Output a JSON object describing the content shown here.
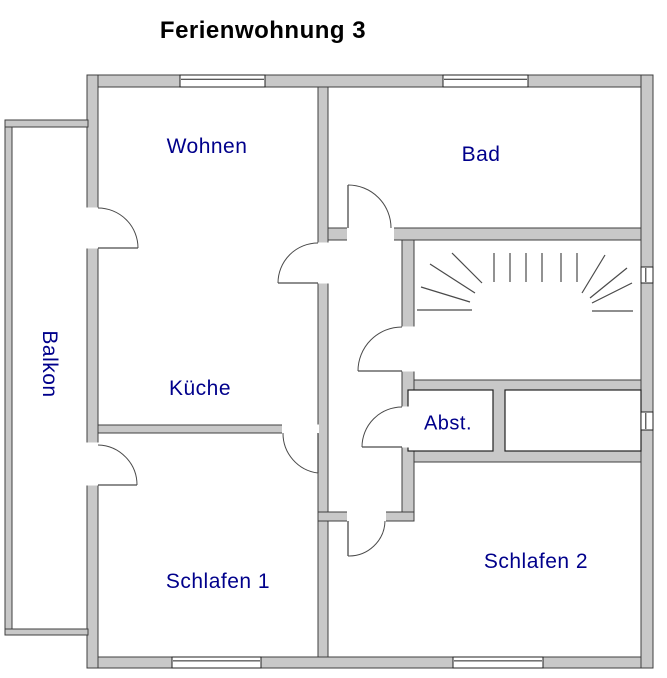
{
  "title": "Ferienwohnung 3",
  "rooms": {
    "wohnen": "Wohnen",
    "bad": "Bad",
    "kueche": "Küche",
    "balkon": "Balkon",
    "abst": "Abst.",
    "schlafen1": "Schlafen 1",
    "schlafen2": "Schlafen 2"
  },
  "colors": {
    "background": "#ffffff",
    "wall_fill": "#c8c8c8",
    "wall_stroke": "#3f3f3f",
    "thin_line": "#4a4a4a",
    "closet_stroke": "#222222",
    "label_blue": "#00008b",
    "title_black": "#000000"
  },
  "floorplan": {
    "width": 667,
    "height": 678,
    "walls": [
      {
        "id": "outer-top",
        "x": 87,
        "y": 75,
        "w": 566,
        "h": 12
      },
      {
        "id": "outer-bottom",
        "x": 87,
        "y": 657,
        "w": 566,
        "h": 11
      },
      {
        "id": "outer-left",
        "x": 87,
        "y": 75,
        "w": 11,
        "h": 593
      },
      {
        "id": "outer-right",
        "x": 641,
        "y": 75,
        "w": 12,
        "h": 593
      },
      {
        "id": "balcony-left",
        "x": 5,
        "y": 120,
        "w": 7,
        "h": 515
      },
      {
        "id": "balcony-top",
        "x": 5,
        "y": 120,
        "w": 83,
        "h": 7
      },
      {
        "id": "balcony-bottom",
        "x": 5,
        "y": 629,
        "w": 83,
        "h": 6
      },
      {
        "id": "spine-vertical",
        "x": 318,
        "y": 87,
        "w": 10,
        "h": 570
      },
      {
        "id": "bad-south",
        "x": 328,
        "y": 228,
        "w": 313,
        "h": 12
      },
      {
        "id": "hall-east",
        "x": 402,
        "y": 240,
        "w": 12,
        "h": 281
      },
      {
        "id": "closet-band",
        "x": 414,
        "y": 380,
        "w": 227,
        "h": 82
      },
      {
        "id": "hall-south",
        "x": 318,
        "y": 512,
        "w": 96,
        "h": 9
      },
      {
        "id": "kueche-south",
        "x": 98,
        "y": 425,
        "w": 220,
        "h": 8
      }
    ],
    "closets": [
      {
        "id": "abst-box",
        "x": 408,
        "y": 390,
        "w": 85,
        "h": 61
      },
      {
        "id": "closet-box",
        "x": 505,
        "y": 390,
        "w": 136,
        "h": 61
      }
    ],
    "openings": [
      {
        "id": "balcony-door-wohnen",
        "x": 87,
        "y": 208,
        "w": 11,
        "h": 40
      },
      {
        "id": "wohnen-to-hall",
        "x": 318,
        "y": 243,
        "w": 10,
        "h": 40
      },
      {
        "id": "hall-to-bad",
        "x": 348,
        "y": 228,
        "w": 45,
        "h": 12
      },
      {
        "id": "hall-to-stairs",
        "x": 402,
        "y": 327,
        "w": 12,
        "h": 44
      },
      {
        "id": "hall-to-abst",
        "x": 402,
        "y": 407,
        "w": 12,
        "h": 40
      },
      {
        "id": "kueche-to-schlafen1",
        "x": 283,
        "y": 425,
        "w": 35,
        "h": 8
      },
      {
        "id": "balcony-door-schlafen1",
        "x": 87,
        "y": 443,
        "w": 11,
        "h": 42
      },
      {
        "id": "hall-to-schlafen2",
        "x": 348,
        "y": 512,
        "w": 37,
        "h": 9
      }
    ],
    "windows": [
      {
        "id": "window-wohnen-north",
        "x": 180,
        "y": 75,
        "w": 85,
        "h": 12,
        "dir": "h"
      },
      {
        "id": "window-bad-north",
        "x": 443,
        "y": 75,
        "w": 85,
        "h": 12,
        "dir": "h"
      },
      {
        "id": "window-schlafen1-south",
        "x": 172,
        "y": 657,
        "w": 89,
        "h": 11,
        "dir": "h"
      },
      {
        "id": "window-schlafen2-south",
        "x": 453,
        "y": 657,
        "w": 90,
        "h": 11,
        "dir": "h"
      },
      {
        "id": "window-stairs-east",
        "x": 641,
        "y": 267,
        "w": 12,
        "h": 16,
        "dir": "v"
      },
      {
        "id": "window-closet-east",
        "x": 641,
        "y": 412,
        "w": 12,
        "h": 18,
        "dir": "v"
      }
    ],
    "doors": [
      {
        "id": "door-balcony-wohnen",
        "leaf": "M98,248 L138,248",
        "arc": "M138,248 A40,40 0 0 0 98,208"
      },
      {
        "id": "door-wohnen-hall",
        "leaf": "M318,283 L278,283",
        "arc": "M278,283 A40,40 0 0 1 318,243"
      },
      {
        "id": "door-hall-bad",
        "leaf": "M348,228 L348,185",
        "arc": "M348,185 A43,43 0 0 1 391,228"
      },
      {
        "id": "door-hall-stairs",
        "leaf": "M402,371 L358,371",
        "arc": "M358,371 A44,44 0 0 1 402,327"
      },
      {
        "id": "door-hall-abst",
        "leaf": "M402,447 L362,447",
        "arc": "M362,447 A40,40 0 0 1 402,407"
      },
      {
        "id": "door-kueche-schlafen1",
        "leaf": "M318,433 L318,473",
        "arc": "M318,473 A40,40 0 0 1 283,433"
      },
      {
        "id": "door-balcony-schlafen1",
        "leaf": "M98,485 L137,485",
        "arc": "M137,485 A40,40 0 0 0 98,445"
      },
      {
        "id": "door-hall-schlafen2",
        "leaf": "M348,521 L348,556",
        "arc": "M348,556 A36,36 0 0 0 385,521"
      }
    ],
    "stairs": {
      "verticals": [
        [
          494,
          253,
          494,
          282
        ],
        [
          510,
          253,
          510,
          282
        ],
        [
          526,
          253,
          526,
          282
        ],
        [
          542,
          253,
          542,
          282
        ],
        [
          561,
          253,
          561,
          282
        ],
        [
          577,
          253,
          577,
          282
        ]
      ],
      "left_fan": [
        [
          417,
          310,
          472,
          310
        ],
        [
          421,
          287,
          470,
          302
        ],
        [
          430,
          264,
          475,
          293
        ],
        [
          452,
          253,
          482,
          283
        ]
      ],
      "right_fan": [
        [
          592,
          311,
          633,
          311
        ],
        [
          592,
          303,
          632,
          283
        ],
        [
          590,
          298,
          627,
          268
        ],
        [
          582,
          293,
          605,
          255
        ]
      ]
    }
  }
}
